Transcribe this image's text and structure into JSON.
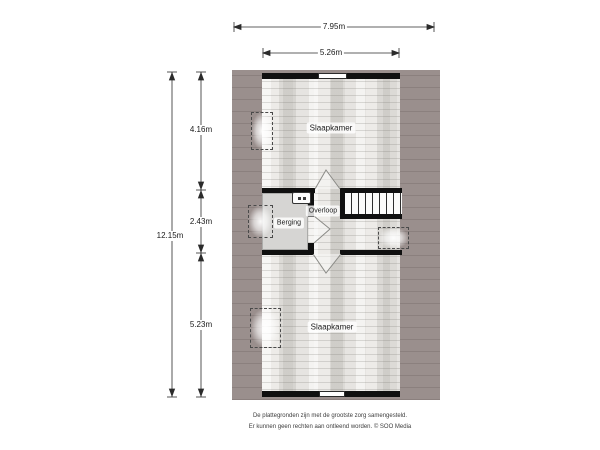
{
  "plan": {
    "title": "first-floor-floorplan",
    "dims": {
      "top_total": "7.95m",
      "top_inner": "5.26m",
      "left_total": "12.15m",
      "left_top": "4.16m",
      "left_middle": "2.43m",
      "left_bottom": "5.23m"
    },
    "rooms": {
      "bedroom_top": "Slaapkamer",
      "bedroom_bottom": "Slaapkamer",
      "storage": "Berging",
      "landing": "Overloop"
    },
    "icons": {
      "boiler": "boiler-unit-icon",
      "skylights": [
        "skylight-window",
        "skylight-window",
        "skylight-window",
        "skylight-window"
      ],
      "stairs": "staircase"
    },
    "colors": {
      "roof_band": "#9a8f8d",
      "wall": "#101010",
      "floor_texture_base": "#e3e1de",
      "storage_floor": "#d6d5d3",
      "dimension_lines": "#2b2b2b"
    }
  },
  "footer": {
    "line1": "De plattegronden zijn met de grootste zorg samengesteld.",
    "line2": "Er kunnen geen rechten aan ontleend worden. © SOO Media"
  }
}
